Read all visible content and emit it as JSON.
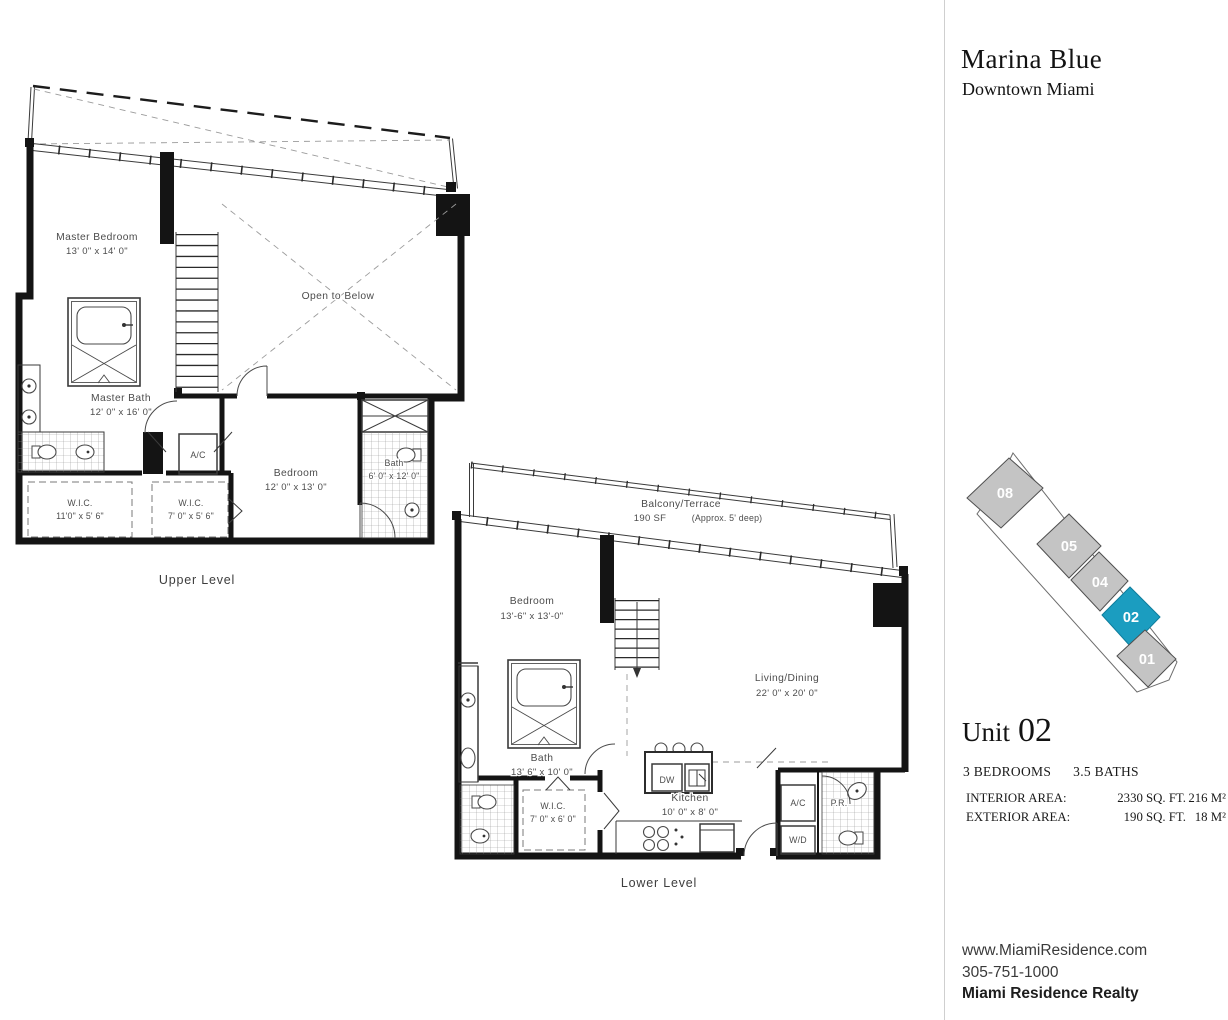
{
  "header": {
    "title": "Marina Blue",
    "subtitle": "Downtown Miami"
  },
  "plans": {
    "upper": {
      "level_label": "Upper Level",
      "master_bedroom_name": "Master Bedroom",
      "master_bedroom_dims": "13' 0\" x 14' 0\"",
      "open_to_below": "Open to Below",
      "master_bath_name": "Master Bath",
      "master_bath_dims": "12' 0\" x 16' 0\"",
      "ac_label": "A/C",
      "wic1_name": "W.I.C.",
      "wic1_dims": "11'0\" x 5' 6\"",
      "wic2_name": "W.I.C.",
      "wic2_dims": "7' 0\" x 5' 6\"",
      "bedroom_name": "Bedroom",
      "bedroom_dims": "12' 0\" x 13' 0\"",
      "bath_name": "Bath",
      "bath_dims": "6' 0\" x 12' 0\""
    },
    "lower": {
      "level_label": "Lower Level",
      "balcony_name": "Balcony/Terrace",
      "balcony_area": "190 SF",
      "balcony_note": "(Approx. 5' deep)",
      "bedroom_name": "Bedroom",
      "bedroom_dims": "13'-6\" x 13'-0\"",
      "bath_name": "Bath",
      "bath_dims": "13' 6\" x 10' 0\"",
      "wic_name": "W.I.C.",
      "wic_dims": "7' 0\" x 6' 0\"",
      "kitchen_name": "Kitchen",
      "kitchen_dims": "10' 0\" x 8' 0\"",
      "living_name": "Living/Dining",
      "living_dims": "22' 0\" x 20' 0\"",
      "dw_label": "DW",
      "ac_label": "A/C",
      "wd_label": "W/D",
      "pr_label": "P.R."
    }
  },
  "keyplan": {
    "units": [
      {
        "id": "08",
        "highlighted": false
      },
      {
        "id": "05",
        "highlighted": false
      },
      {
        "id": "04",
        "highlighted": false
      },
      {
        "id": "02",
        "highlighted": true
      },
      {
        "id": "01",
        "highlighted": false
      }
    ],
    "highlight_color": "#1b9dc0",
    "unit_color": "#c4c4c4",
    "label_color": "#ffffff"
  },
  "unit_info": {
    "title_prefix": "Unit",
    "unit_number": "02",
    "bedrooms": "3 BEDROOMS",
    "baths": "3.5 BATHS",
    "areas": [
      {
        "label": "INTERIOR AREA:",
        "imperial": "2330 SQ. FT.",
        "metric": "216 M²"
      },
      {
        "label": "EXTERIOR AREA:",
        "imperial": "190 SQ. FT.",
        "metric": "18 M²"
      }
    ]
  },
  "footer": {
    "website": "www.MiamiResidence.com",
    "phone": "305-751-1000",
    "company": "Miami Residence Realty"
  }
}
